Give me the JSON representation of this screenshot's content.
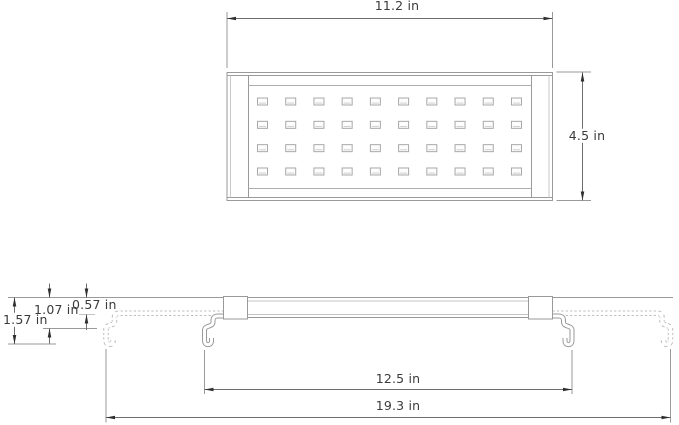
{
  "drawing": {
    "views": [
      "top-view",
      "side-view"
    ],
    "unit": "in"
  },
  "top_view": {
    "width_label": "11.2 in",
    "height_label": "4.5 in",
    "led_grid": {
      "rows": 4,
      "cols": 10
    }
  },
  "side_view": {
    "overall_height_label": "1.57 in",
    "mid_height_label": "1.07 in",
    "body_thickness_label": "0.57 in",
    "inner_span_label": "12.5 in",
    "extended_span_label": "19.3 in"
  },
  "colors": {
    "background": "#ffffff",
    "object_line": "#9a9a9a",
    "light_line": "#c4c4c4",
    "dimension_line": "#6e6e6e",
    "extension_line": "#9a9a9a",
    "arrowhead": "#2f2f2f",
    "text": "#3b3b3b"
  }
}
